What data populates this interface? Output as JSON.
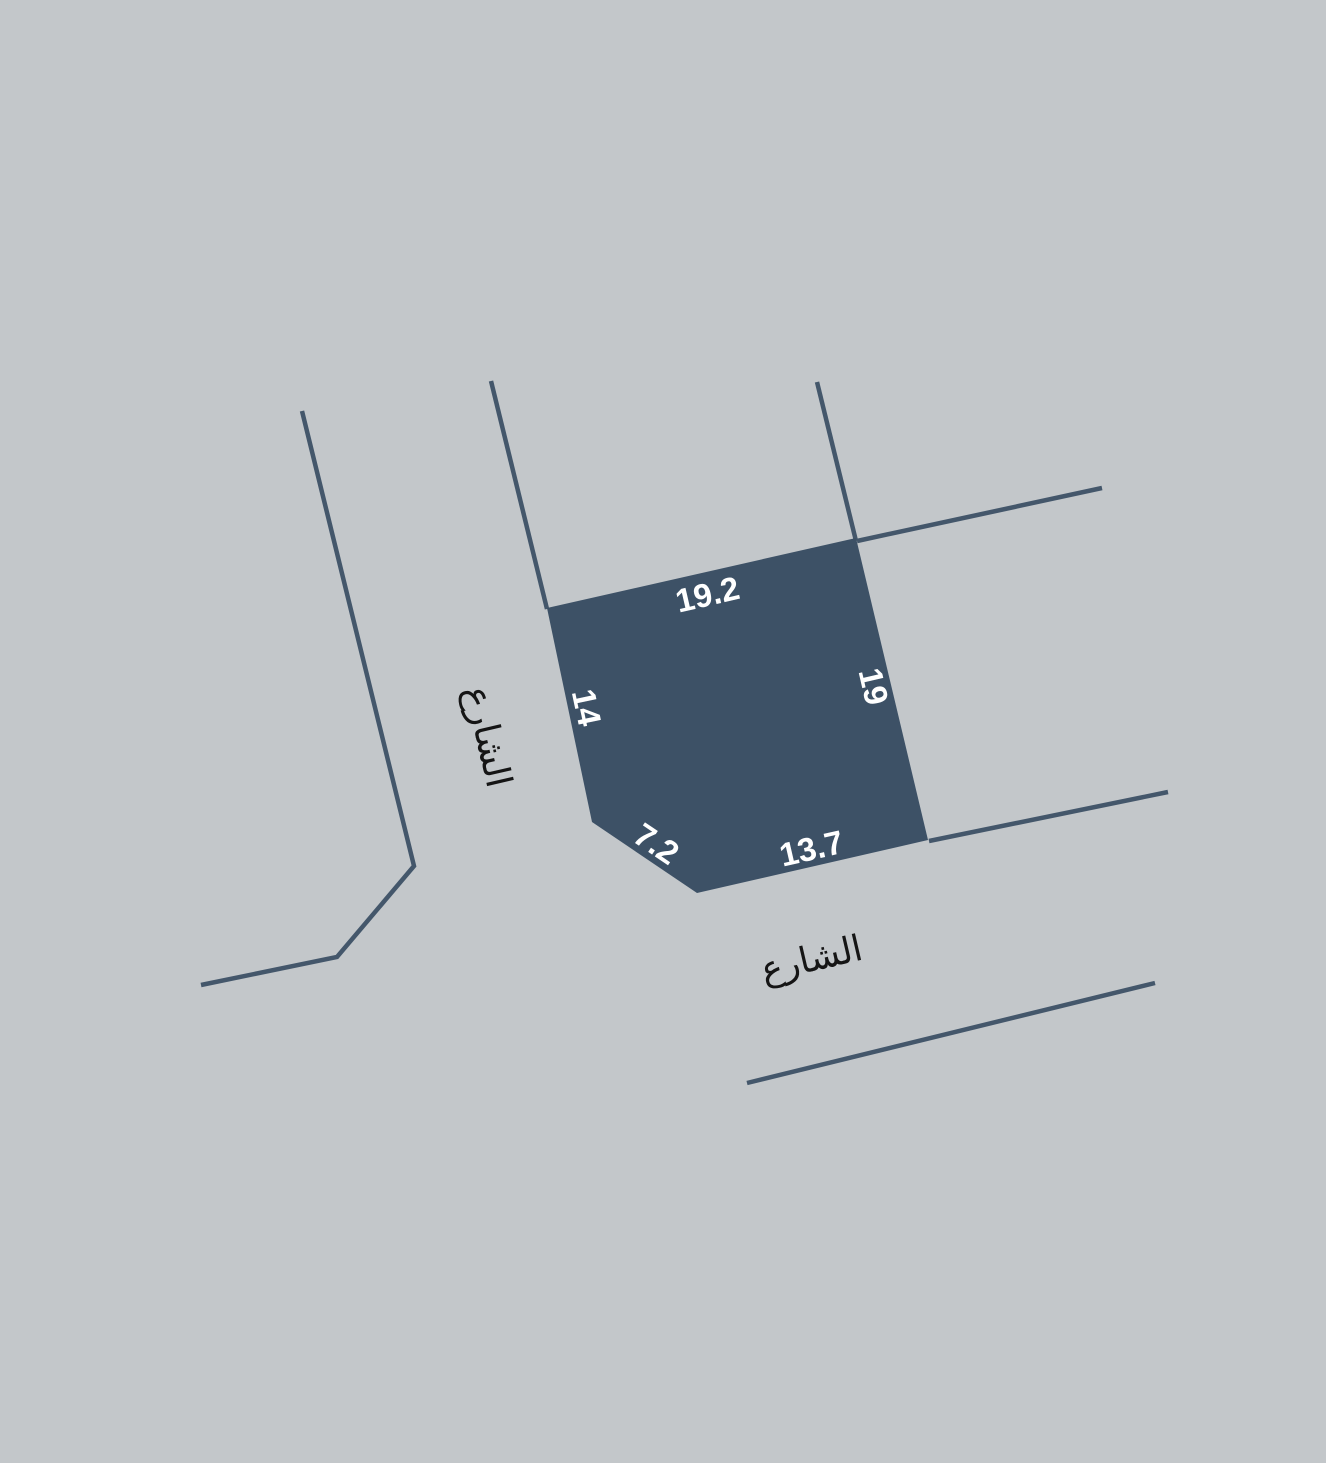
{
  "canvas": {
    "background": "#c3c7ca"
  },
  "colors": {
    "parcel_fill": "#3d5166",
    "street_line": "#44576b",
    "dimension_text": "#ffffff",
    "street_text": "#151515"
  },
  "parcel": {
    "points": "547,608 856,538 928,840 697,893 592,822",
    "dimensions": [
      {
        "value": "19.2",
        "x": 708,
        "y": 597,
        "rotate": -13
      },
      {
        "value": "19",
        "x": 871,
        "y": 687,
        "rotate": 77
      },
      {
        "value": "14",
        "x": 584,
        "y": 708,
        "rotate": 78
      },
      {
        "value": "7.2",
        "x": 655,
        "y": 846,
        "rotate": 34
      },
      {
        "value": "13.7",
        "x": 812,
        "y": 851,
        "rotate": -13
      }
    ]
  },
  "streets": {
    "lines": [
      {
        "id": "left-street-west-edge",
        "points": "302,411 414,866 337,957 201,985"
      },
      {
        "id": "left-street-east-edge",
        "points": "491,381 547,609"
      },
      {
        "id": "north-boundary-line",
        "points": "817,382 856,541"
      },
      {
        "id": "northeast-boundary-line",
        "points": "857,541 1102,488"
      },
      {
        "id": "south-street-north-edge",
        "points": "929,841 1168,792"
      },
      {
        "id": "south-street-south-edge",
        "points": "747,1083 1155,983"
      }
    ],
    "labels": [
      {
        "text": "الشارع",
        "x": 486,
        "y": 737,
        "rotate": 77
      },
      {
        "text": "الشارع",
        "x": 812,
        "y": 961,
        "rotate": -13
      }
    ]
  }
}
